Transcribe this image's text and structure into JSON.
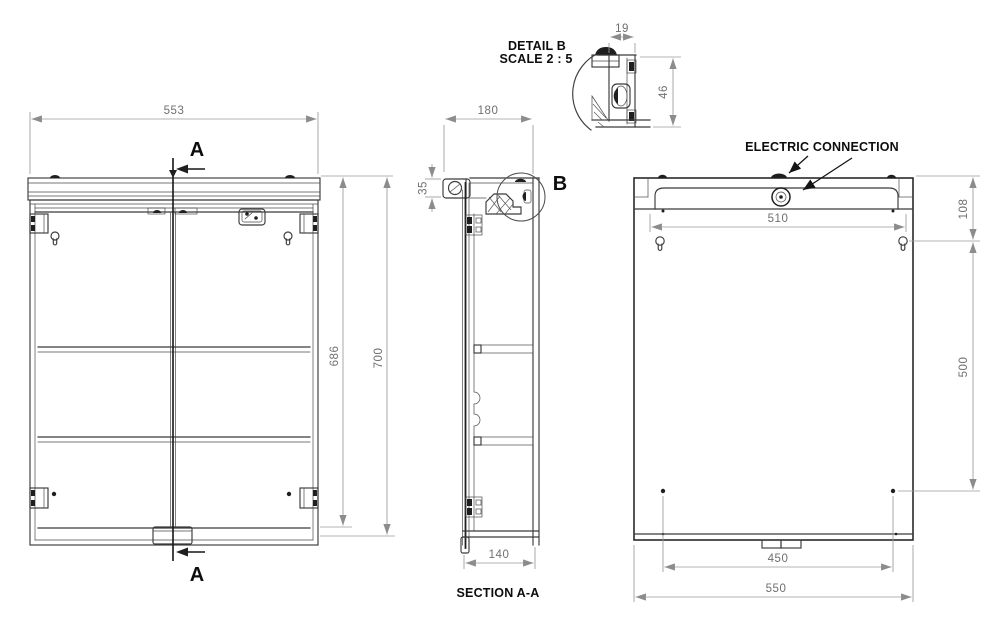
{
  "front_view": {
    "dim_width": "553",
    "dim_body_height": "686",
    "dim_total_height": "700",
    "section_marker": "A"
  },
  "section_view": {
    "dim_depth_total": "180",
    "dim_light_height": "35",
    "dim_body_depth": "140",
    "title": "SECTION A-A",
    "detail_marker": "B"
  },
  "detail_b": {
    "title": "DETAIL B",
    "scale_label": "SCALE 2 : 5",
    "dim_clip_width": "19",
    "dim_clip_height": "46"
  },
  "back_view": {
    "annotation": "ELECTRIC CONNECTION",
    "dim_top_rail_width": "510",
    "dim_top_to_hanger": "108",
    "dim_hanger_to_screw": "500",
    "dim_screw_span": "450",
    "dim_overall_width": "550"
  },
  "colors": {
    "object_line": "#3b3b3b",
    "dim_line": "#9a9a9a",
    "dim_text": "#6f6f6f",
    "label_text": "#0d0d0d",
    "background": "#ffffff"
  }
}
